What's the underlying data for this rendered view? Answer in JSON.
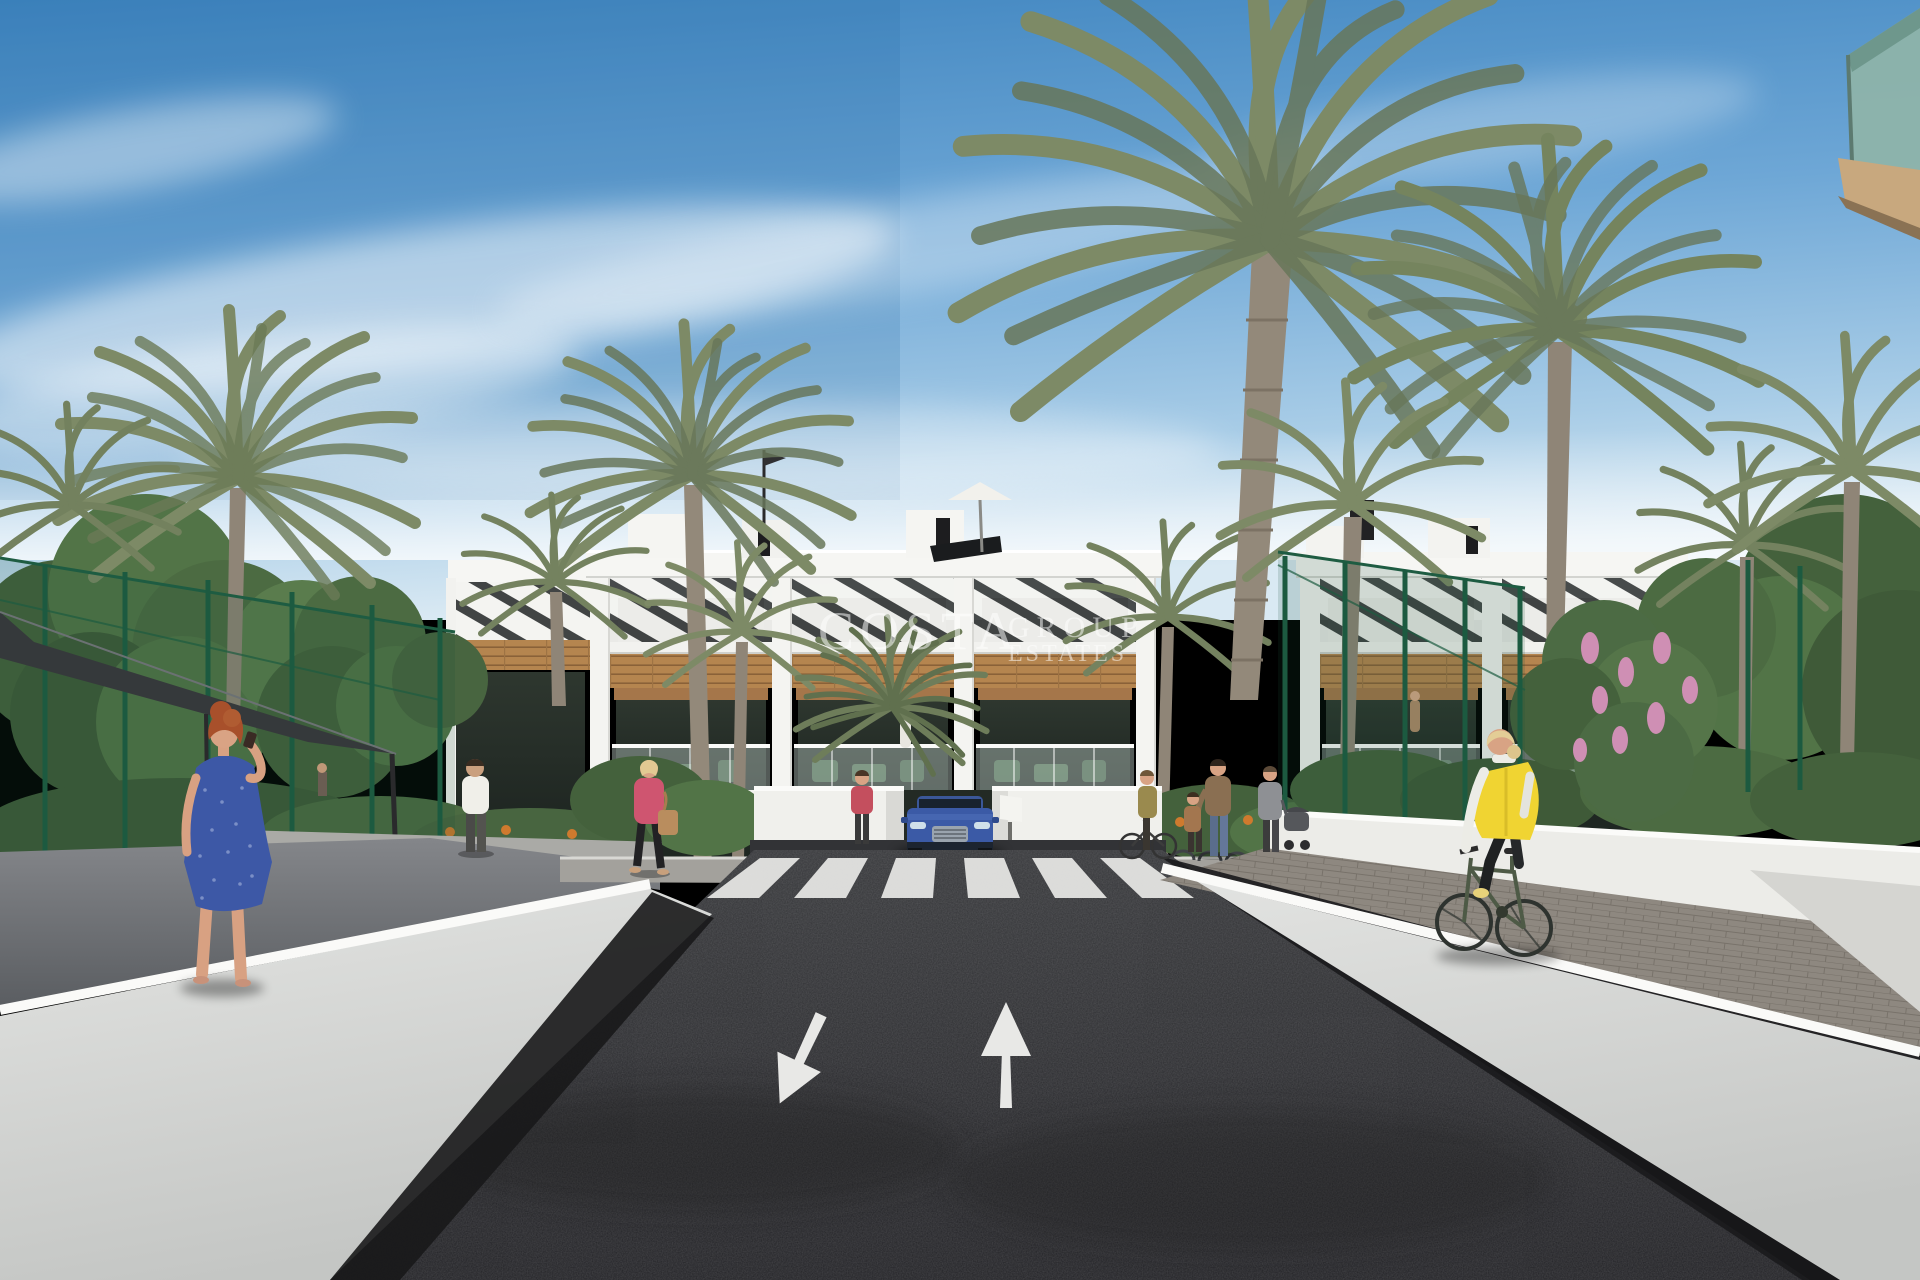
{
  "watermark": {
    "line1": "COSTA",
    "line2": "GROUP",
    "line3": "ESTATES"
  },
  "scene": {
    "description": "3D architectural render: modern white apartment complex with wood accents and pergola roofs, palm trees, dark asphalt access road with crosswalk and two painted lane arrows, pedestrians, a blue SUV at the garage entrance, and a cyclist in a yellow vest on the right-hand path",
    "colors": {
      "sky_top": "#3e84bf",
      "sky_horizon": "#d9e9f3",
      "facade_white": "#f3f3ef",
      "wood_accent": "#b5854f",
      "window_glass": "#27302a",
      "balcony_glass": "#b7c8c0",
      "palm_frond": "#7d8a66",
      "tree_green": "#4e6b43",
      "fence_green": "#1e5c42",
      "road_asphalt": "#2b2c2e",
      "road_marking_white": "#e9e9e7",
      "car_blue": "#3b5aa6",
      "cyclist_vest_yellow": "#f0d432",
      "walking_dress_blue": "#3d58a6"
    }
  }
}
